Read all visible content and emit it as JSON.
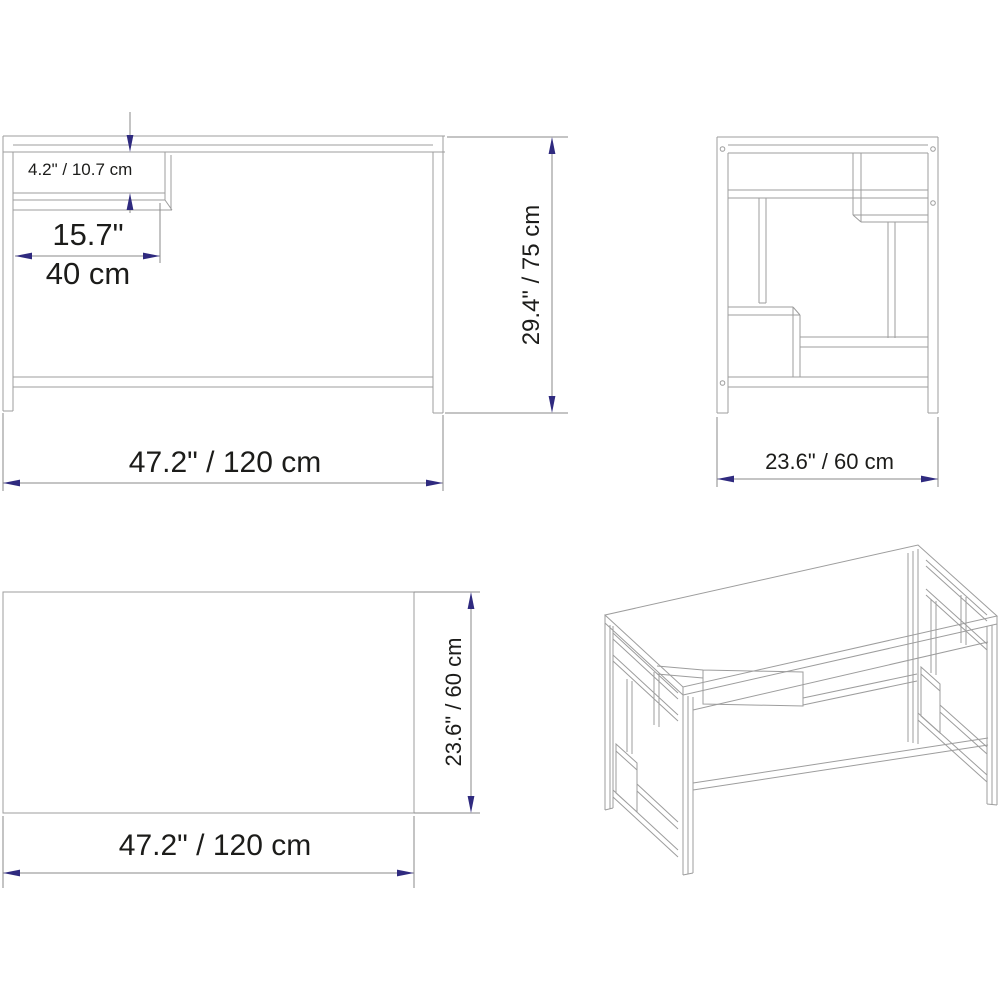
{
  "drawing": {
    "front_view": {
      "shelf_height": "4.2\" / 10.7 cm",
      "shelf_width_in": "15.7\"",
      "shelf_width_cm": "40 cm",
      "overall_width": "47.2\" / 120 cm",
      "overall_height": "29.4\" / 75 cm"
    },
    "side_view": {
      "overall_depth": "23.6\" / 60 cm"
    },
    "top_view": {
      "overall_width": "47.2\" / 120 cm",
      "overall_depth": "23.6\" / 60 cm"
    }
  },
  "colors": {
    "background": "#ffffff",
    "line": "#9d9d9d",
    "dimension-line": "#8a8a8a",
    "arrow": "#2f2a7f",
    "text": "#1c1c1a"
  }
}
